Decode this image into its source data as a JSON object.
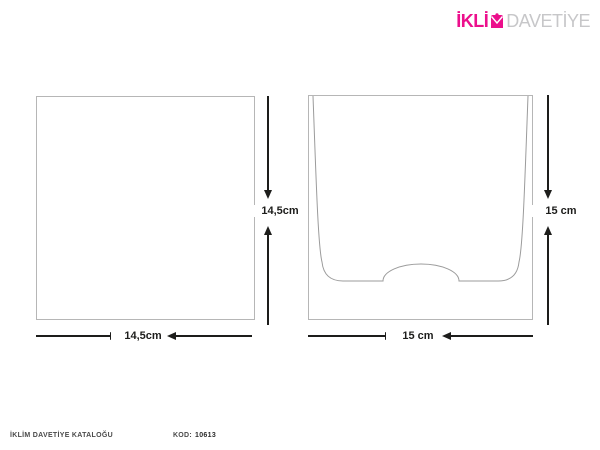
{
  "logo": {
    "brand_prefix": "İKLİ",
    "brand_m_letter": "M",
    "brand_secondary": "DAVETİYE",
    "icon": "envelope-icon",
    "accent_color": "#ec0f8c",
    "secondary_color": "#c7c7c9"
  },
  "figures": {
    "card": {
      "height_label": "14,5cm",
      "width_label": "14,5cm"
    },
    "envelope": {
      "height_label": "15 cm",
      "width_label": "15 cm"
    }
  },
  "footer": {
    "catalog_label": "İKLİM DAVETİYE KATALOĞU",
    "code_label": "KOD:",
    "code_value": "10613"
  },
  "colors": {
    "dimension_line": "#1d1d1b",
    "outline": "#b6b6b6",
    "pocket_outline": "#9b9b9b"
  }
}
